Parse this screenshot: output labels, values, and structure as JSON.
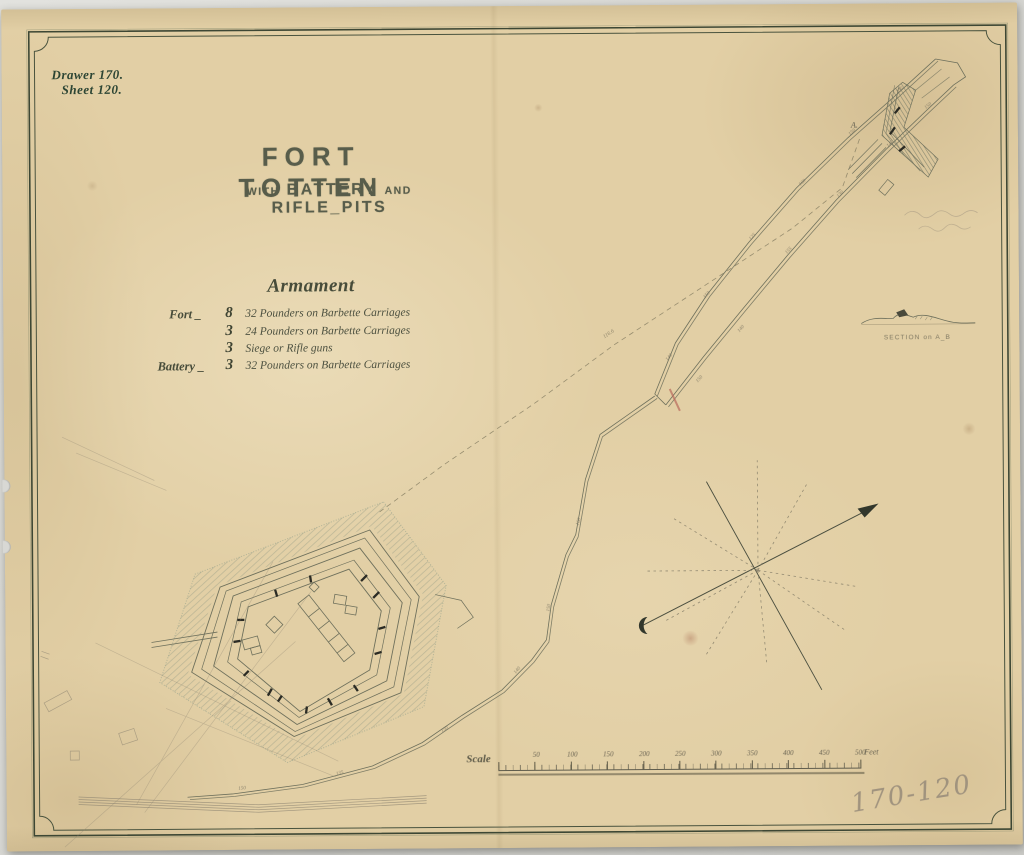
{
  "catalog": {
    "drawer": "Drawer 170.",
    "sheet": "Sheet 120.",
    "pencil_number": "170-120"
  },
  "title": {
    "main": "FORT TOTTEN",
    "sub_with": "WITH",
    "sub_battery": "BATTERY",
    "sub_and": "AND",
    "sub_riflepits": "RIFLE_PITS"
  },
  "armament": {
    "heading": "Armament",
    "rows": [
      {
        "site": "Fort _",
        "qty": "8",
        "desc": "32 Pounders on Barbette Carriages"
      },
      {
        "site": "",
        "qty": "3",
        "desc": "24 Pounders on Barbette Carriages"
      },
      {
        "site": "",
        "qty": "3",
        "desc": "Siege or Rifle guns"
      },
      {
        "site": "Battery _",
        "qty": "3",
        "desc": "32 Pounders on Barbette Carriages"
      }
    ]
  },
  "section": {
    "label": "SECTION on A_B",
    "point_a": "A."
  },
  "scale": {
    "label": "Scale",
    "ticks": [
      "50",
      "100",
      "150",
      "200",
      "250",
      "300",
      "350",
      "400",
      "450",
      "500"
    ],
    "unit": "Feet"
  },
  "survey_marks": {
    "dashed_measure": "116.6",
    "distances": [
      "140",
      "150",
      "125",
      "160",
      "150",
      "135",
      "150",
      "140",
      "155",
      "130",
      "145",
      "150",
      "160",
      "150",
      "140",
      "150",
      "135",
      "150"
    ]
  },
  "colors": {
    "paper": "#e2cfa5",
    "map_ink": "#6e705c",
    "frame_ink": "#3d4734",
    "title_ink": "#585d4b",
    "pencil": "#9a8d7b",
    "crossing_mark": "#b9695c"
  }
}
